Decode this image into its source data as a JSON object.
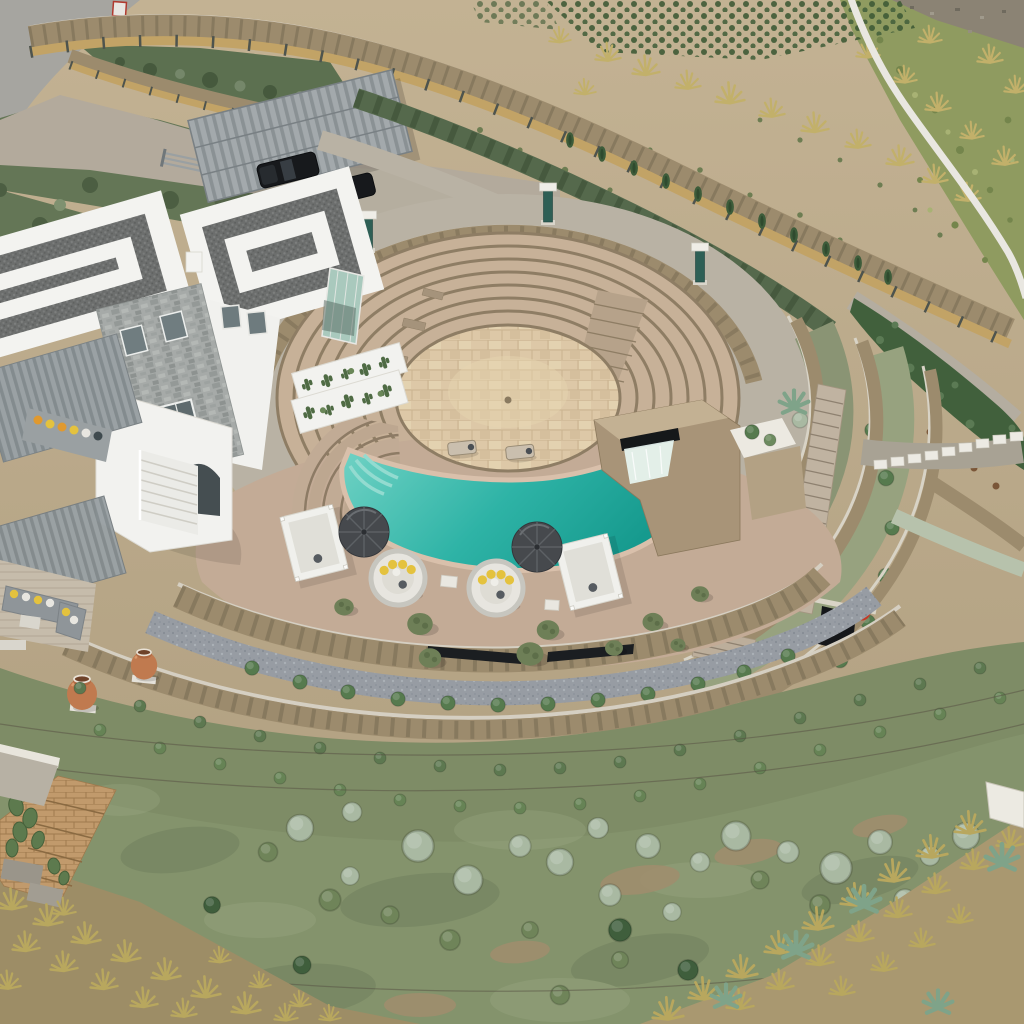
{
  "scene": {
    "description": "Aerial drone photograph of a Cycladic-style hillside villa estate: a circular stone amphitheatre of seven concentric steps descends to a turquoise pool with a stone waterfall block; white flat-roofed villa with dark pebble-inlay roof patterns, carport with two black SUVs, bamboo-topped stone boundary walls, curved terraced garden walls, umbrellas and daybeds with yellow cushions on the pool deck, terracotta amphorae, and a Mediterranean drought garden with sage shrubs, ochre grass tufts and agaves below.",
    "view": "high oblique aerial",
    "lighting": "soft overcast daylight"
  },
  "colors": {
    "road": "#a6a5a0",
    "driveway": "#b3aa9c",
    "concrete": "#b9b2a4",
    "pool_deck": "#c3ab96",
    "ring_tread": "#c7b198",
    "ring_riser": "#8e7d64",
    "stage_floor": "#ddc8a7",
    "pool": "#2eb3a6",
    "pool_shallow": "#74d4c6",
    "pool_deep": "#15998d",
    "pool_coping": "#d9c0ab",
    "stone_wall": "#9c8b6d",
    "wall_cap": "#d5cfc2",
    "bamboo_fence": "#c2a366",
    "roof_white": "#f3f3f0",
    "roof_pebble": "#6c6e6d",
    "umbrella": "#46494d",
    "cushion_yellow": "#e4c23e",
    "garden_green": "#84936c",
    "bush_sage": "#a9b9a2",
    "bush_dark": "#3f5e3c",
    "grass_ochre": "#b8a75e",
    "brick_path": "#c19a6c",
    "amphora_terracotta": "#c07a4f",
    "red_pot": "#c23b2a",
    "column_teal": "#2e5f55",
    "car_black": "#17191c"
  },
  "features": [
    {
      "name": "amphitheatre",
      "label": "Circular stone amphitheatre with seven step rings"
    },
    {
      "name": "pool",
      "label": "Turquoise crescent pool with waterfall and splash jet"
    },
    {
      "name": "villa",
      "label": "White Cycladic villa with pebble-pattern flat roofs and stone tower"
    },
    {
      "name": "carport",
      "label": "Slatted carport sheltering two black SUVs"
    },
    {
      "name": "boundary-wall",
      "label": "Stone boundary wall topped with bamboo fencing"
    },
    {
      "name": "pool-deck",
      "label": "Deck with two dark umbrellas, round daybeds, canopy daybeds and olive trees"
    },
    {
      "name": "terraces",
      "label": "Curved stone terrace walls with staircases and planted beds"
    },
    {
      "name": "garden",
      "label": "Drought garden of sage shrubs, groundcover, grass tufts and agaves"
    },
    {
      "name": "amphorae",
      "label": "Two terracotta amphora urns on the slope"
    },
    {
      "name": "red-pot",
      "label": "Red pot beside lower wall opening"
    }
  ]
}
